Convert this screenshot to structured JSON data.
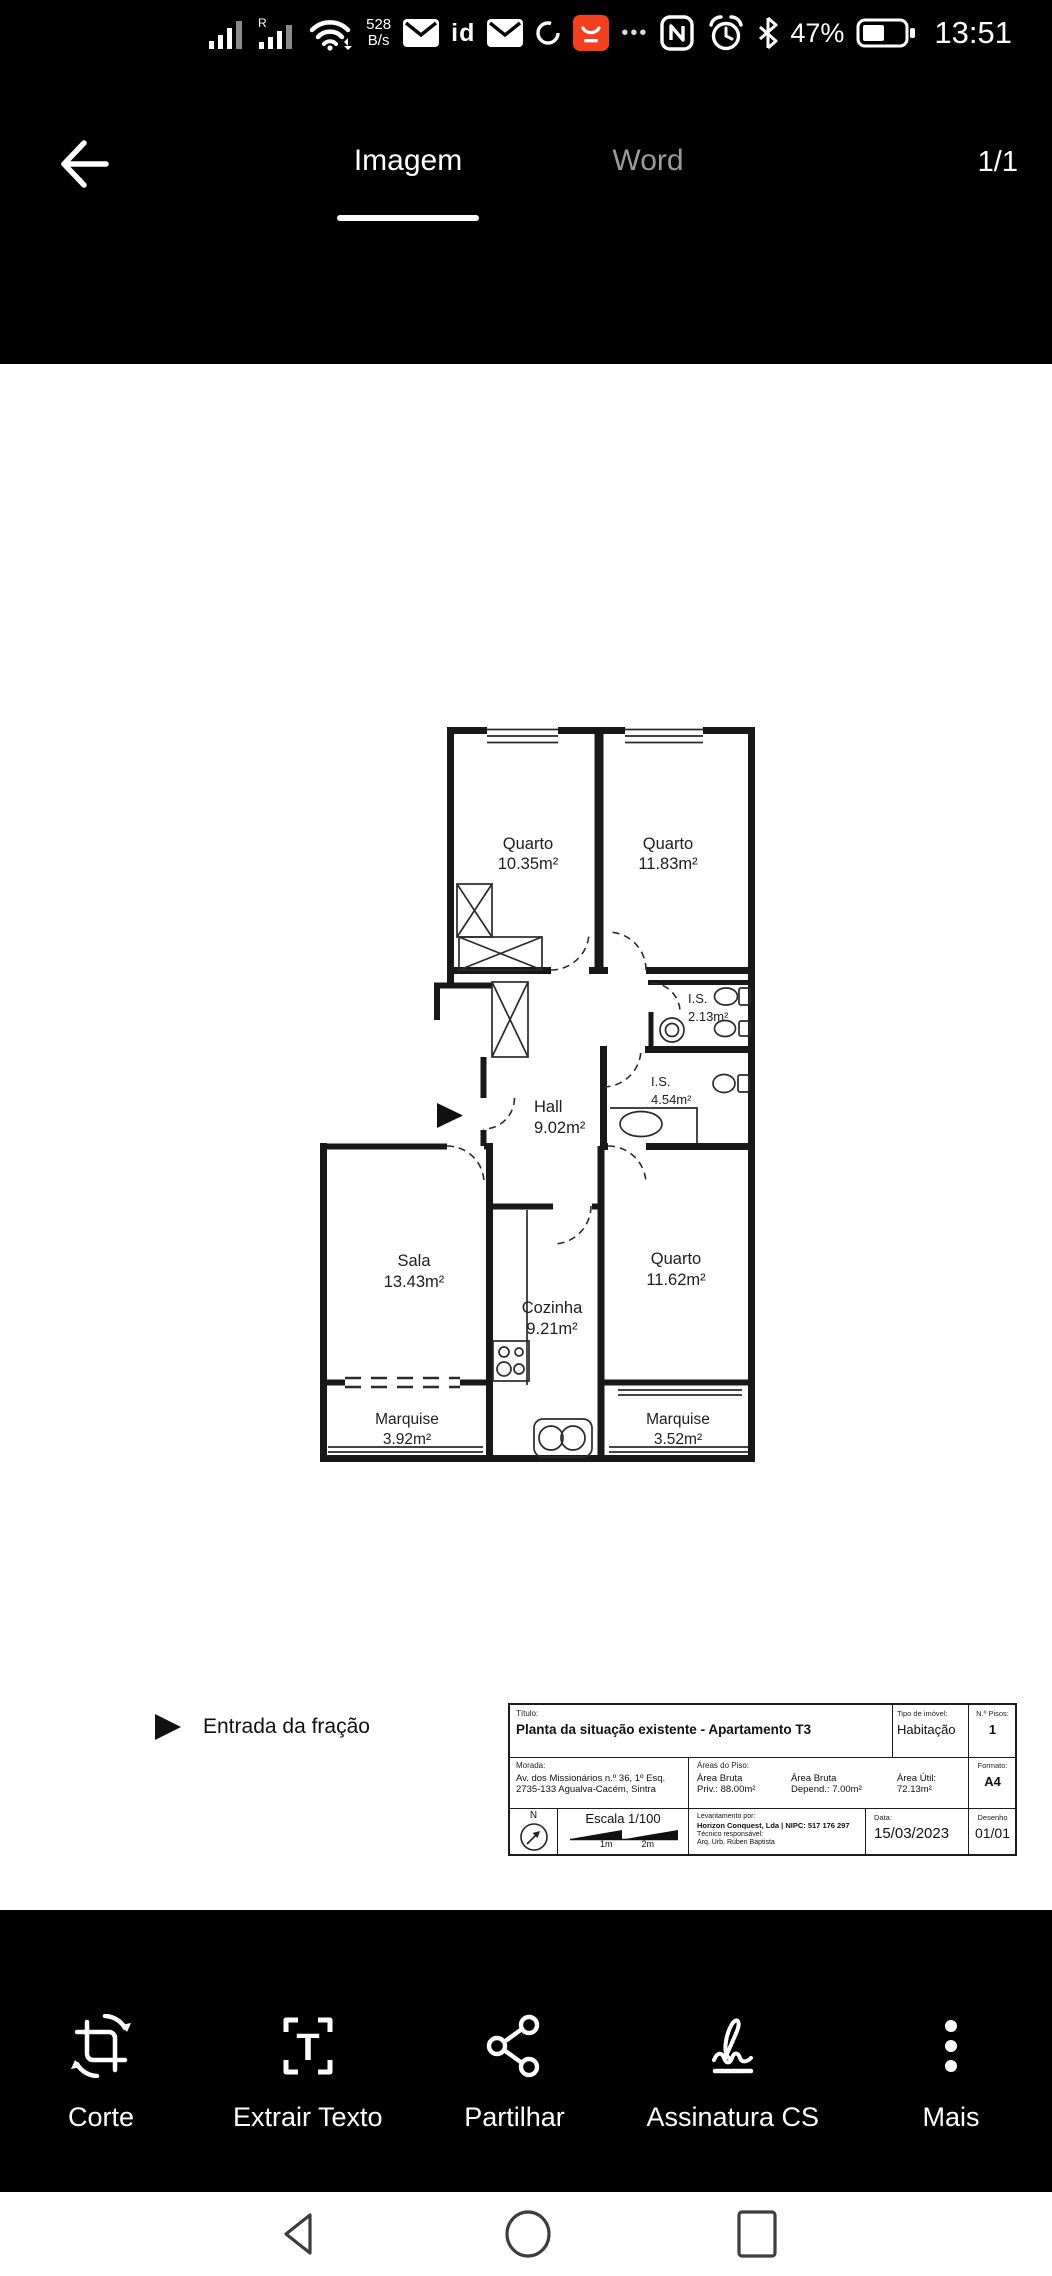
{
  "status_bar": {
    "net_speed_value": "528",
    "net_speed_unit": "B/s",
    "roaming_indicator": "R",
    "id_badge": "id",
    "overflow_dots": "•••",
    "battery_percent": "47%",
    "time": "13:51"
  },
  "header": {
    "tab_image": "Imagem",
    "tab_word": "Word",
    "page_indicator": "1/1"
  },
  "floor_plan": {
    "rooms": [
      {
        "name": "Quarto",
        "area": "10.35m²"
      },
      {
        "name": "Quarto",
        "area": "11.83m²"
      },
      {
        "name": "I.S.",
        "area": "2.13m²"
      },
      {
        "name": "I.S.",
        "area": "4.54m²"
      },
      {
        "name": "Hall",
        "area": "9.02m²"
      },
      {
        "name": "Sala",
        "area": "13.43m²"
      },
      {
        "name": "Cozinha",
        "area": "9.21m²"
      },
      {
        "name": "Quarto",
        "area": "11.62m²"
      },
      {
        "name": "Marquise",
        "area": "3.92m²"
      },
      {
        "name": "Marquise",
        "area": "3.52m²"
      }
    ],
    "legend": {
      "entrance_label": "Entrada da fração"
    },
    "title_block": {
      "titulo_label": "Título:",
      "titulo": "Planta da situação existente - Apartamento T3",
      "tipo_imovel_label": "Tipo de imóvel:",
      "tipo_imovel": "Habitação",
      "n_pisos_label": "N.º Pisos:",
      "n_pisos": "1",
      "morada_label": "Morada:",
      "morada_linha1": "Av. dos Missionários n.º 36, 1º Esq.",
      "morada_linha2": "2735-133 Agualva-Cacém, Sintra",
      "areas_piso_label": "Áreas do Piso:",
      "area_bruta_priv_l1": "Área Bruta",
      "area_bruta_priv_l2": "Priv.: 88.00m²",
      "area_bruta_dep_l1": "Área Bruta",
      "area_bruta_dep_l2": "Depend.: 7.00m²",
      "area_util_l1": "Área Útil:",
      "area_util_l2": "72.13m²",
      "formato_label": "Formato:",
      "formato": "A4",
      "north_label": "N",
      "escala": "Escala 1/100",
      "escala_1m": "1m",
      "escala_2m": "2m",
      "levantamento_label": "Levantamento por:",
      "levantamento_empresa": "Horizon Conquest, Lda | NIPC: 517 176 297",
      "tecnico_label": "Técnico responsável:",
      "tecnico": "Arq. Urb. Rúben Baptista",
      "data_label": "Data:",
      "data": "15/03/2023",
      "desenho_label": "Desenho",
      "desenho": "01/01"
    }
  },
  "toolbar": {
    "items": [
      {
        "label": "Corte",
        "icon": "crop-rotate-icon"
      },
      {
        "label": "Extrair Texto",
        "icon": "extract-text-icon"
      },
      {
        "label": "Partilhar",
        "icon": "share-icon"
      },
      {
        "label": "Assinatura CS",
        "icon": "signature-icon"
      },
      {
        "label": "Mais",
        "icon": "more-icon"
      }
    ]
  },
  "colors": {
    "app_badge_red": "#f4401f",
    "tab_active": "#ffffff",
    "tab_inactive": "#9b9b9b",
    "toolbar_bg": "#000000",
    "nav_icon": "#3d3d3d"
  }
}
